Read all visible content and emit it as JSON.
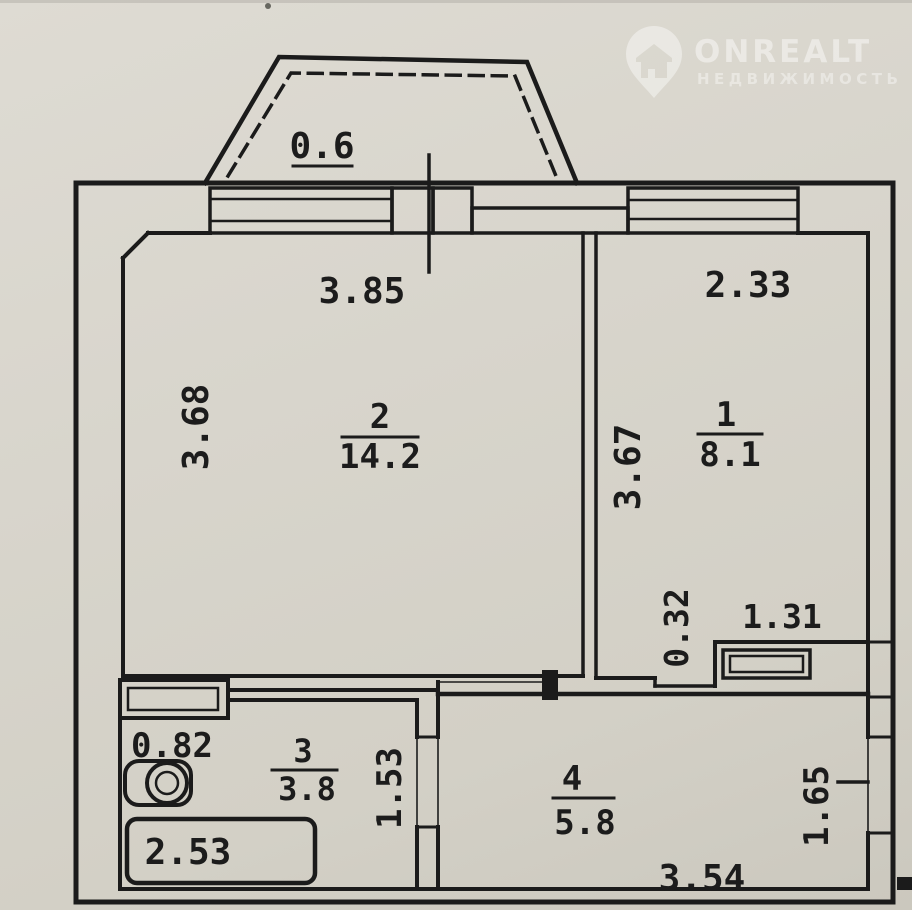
{
  "watermark": {
    "brand": "ONREALT",
    "tagline": "НЕДВИЖИМОСТЬ"
  },
  "balcony": {
    "width_label": "0.6"
  },
  "rooms": {
    "room1": {
      "number": "1",
      "area": "8.1",
      "width": "2.33",
      "height": "3.67"
    },
    "room2": {
      "number": "2",
      "area": "14.2",
      "width": "3.85",
      "height": "3.68"
    },
    "room3": {
      "number": "3",
      "area": "3.8",
      "offset": "0.82",
      "height": "1.53",
      "tub_length": "2.53"
    },
    "room4": {
      "number": "4",
      "area": "5.8",
      "width": "3.54",
      "height": "1.65"
    },
    "niche": {
      "height": "0.32",
      "width": "1.31"
    }
  },
  "colors": {
    "paper": "#d8d5cc",
    "ink": "#1b1b1b",
    "watermark": "rgba(255,255,255,0.42)"
  }
}
